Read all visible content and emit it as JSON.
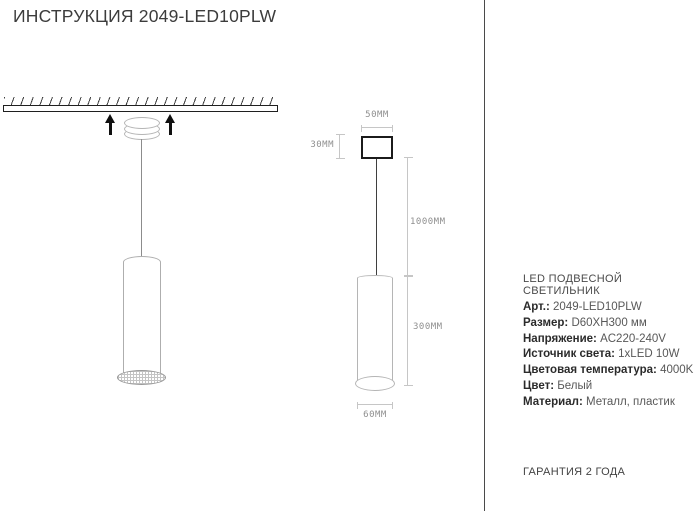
{
  "title": "ИНСТРУКЦИЯ 2049-LED10PLW",
  "dimensions": {
    "canopy_width": "50MM",
    "canopy_height": "30MM",
    "wire_length": "1000MM",
    "body_height": "300MM",
    "body_diameter": "60MM"
  },
  "specs": {
    "heading": "LED ПОДВЕСНОЙ СВЕТИЛЬНИК",
    "items": [
      {
        "label": "Арт.:",
        "value": "2049-LED10PLW"
      },
      {
        "label": "Размер:",
        "value": "D60XH300 мм"
      },
      {
        "label": "Напряжение:",
        "value": "AC220-240V"
      },
      {
        "label": "Источник света:",
        "value": "1xLED 10W"
      },
      {
        "label": "Цветовая температура:",
        "value": "4000K"
      },
      {
        "label": "Цвет:",
        "value": "Белый"
      },
      {
        "label": "Материал:",
        "value": "Металл, пластик"
      }
    ],
    "warranty": "ГАРАНТИЯ 2 ГОДА"
  },
  "colors": {
    "ink": "#1f1f1f",
    "drawing_gray": "#aeaeae",
    "dimension_gray": "#c6c6c6",
    "text_dark": "#3c3c3c"
  }
}
